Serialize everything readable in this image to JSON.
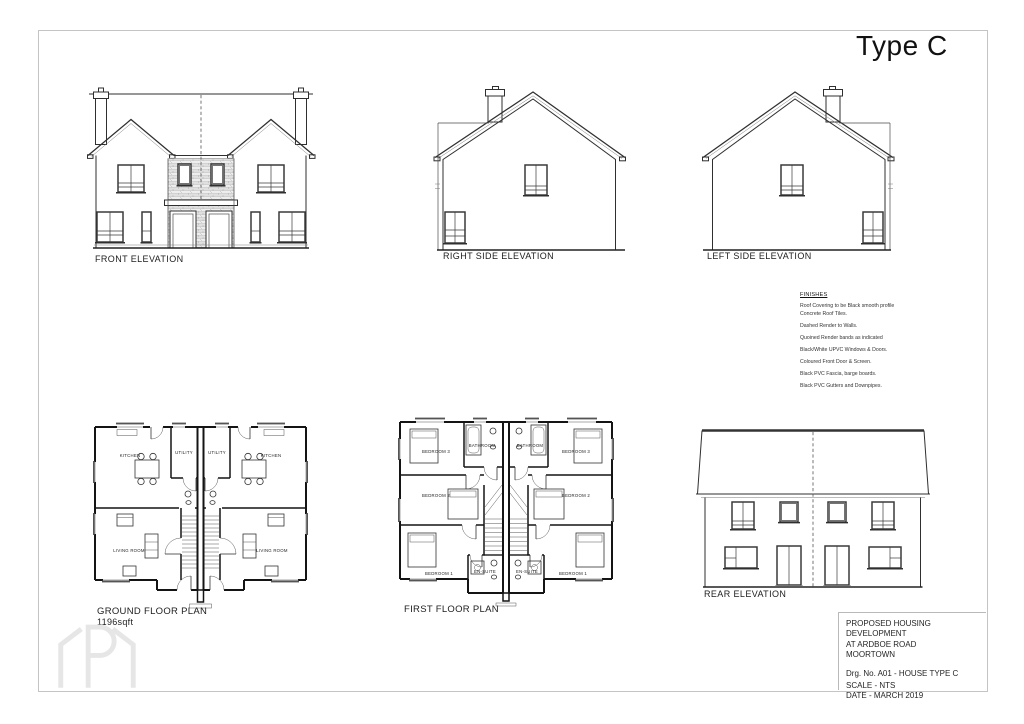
{
  "sheet": {
    "title": "Type C",
    "watermark_icon": "bracketed-p-house-logo"
  },
  "elevations": {
    "front": {
      "label": "FRONT ELEVATION"
    },
    "right_side": {
      "label": "RIGHT SIDE ELEVATION"
    },
    "left_side": {
      "label": "LEFT SIDE ELEVATION"
    },
    "rear": {
      "label": "REAR ELEVATION"
    }
  },
  "plans": {
    "ground": {
      "label": "GROUND FLOOR PLAN",
      "area": "1196sqft",
      "room_labels": [
        "KITCHEN",
        "UTILITY",
        "UTILITY",
        "KITCHEN",
        "LIVING ROOM",
        "LIVING ROOM"
      ]
    },
    "first": {
      "label": "FIRST FLOOR PLAN",
      "room_labels": [
        "BEDROOM 3",
        "BATHROOM",
        "BATHROOM",
        "BEDROOM 3",
        "BEDROOM 2",
        "BEDROOM 2",
        "BEDROOM 1",
        "EN-SUITE",
        "EN-SUITE",
        "BEDROOM 1"
      ]
    }
  },
  "finishes": {
    "heading": "FINISHES",
    "notes": [
      "Roof Covering to be Black smooth profile Concrete Roof Tiles.",
      "Dashed Render to Walls.",
      "Quoined Render bands as indicated",
      "Black/White UPVC Windows & Doors.",
      "Coloured Front Door & Screen.",
      "Black PVC Fascia, barge boards.",
      "Black PVC Gutters and Downpipes."
    ]
  },
  "title_block": {
    "project_line1": "PROPOSED HOUSING DEVELOPMENT",
    "project_line2": "AT ARDBOE ROAD",
    "project_line3": "MOORTOWN",
    "drawing_no": "Drg. No. A01 - HOUSE TYPE C",
    "scale": "SCALE - NTS",
    "date": "DATE - MARCH 2019"
  }
}
